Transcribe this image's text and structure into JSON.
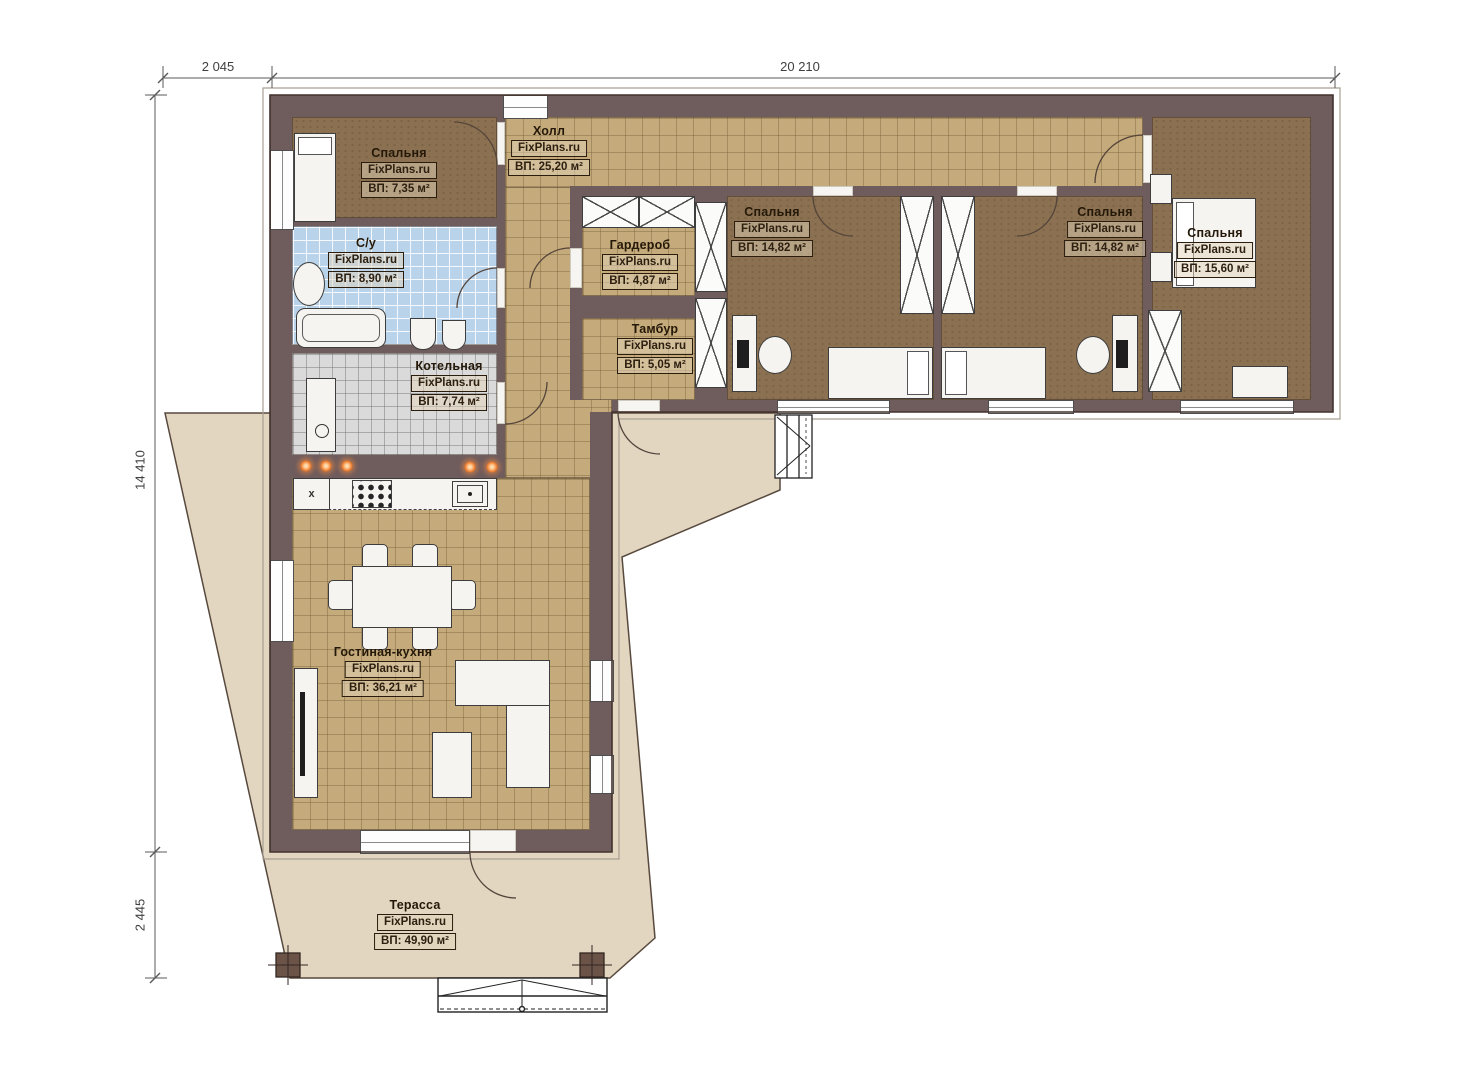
{
  "site": {
    "dimensions": {
      "top_left": "2 045",
      "top_right": "20 210",
      "left_upper": "14 410",
      "left_lower": "2 445"
    }
  },
  "rooms": [
    {
      "id": "bedroom-1",
      "title": "Спальня",
      "source": "FixPlans.ru",
      "area": "ВП: 7,35 м²"
    },
    {
      "id": "bathroom",
      "title": "С/у",
      "source": "FixPlans.ru",
      "area": "ВП: 8,90 м²"
    },
    {
      "id": "boiler-room",
      "title": "Котельная",
      "source": "FixPlans.ru",
      "area": "ВП: 7,74 м²"
    },
    {
      "id": "hall",
      "title": "Холл",
      "source": "FixPlans.ru",
      "area": "ВП: 25,20 м²"
    },
    {
      "id": "wardrobe",
      "title": "Гардероб",
      "source": "FixPlans.ru",
      "area": "ВП: 4,87 м²"
    },
    {
      "id": "vestibule",
      "title": "Тамбур",
      "source": "FixPlans.ru",
      "area": "ВП: 5,05 м²"
    },
    {
      "id": "bedroom-2",
      "title": "Спальня",
      "source": "FixPlans.ru",
      "area": "ВП: 14,82 м²"
    },
    {
      "id": "bedroom-3",
      "title": "Спальня",
      "source": "FixPlans.ru",
      "area": "ВП: 14,82 м²"
    },
    {
      "id": "bedroom-4",
      "title": "Спальня",
      "source": "FixPlans.ru",
      "area": "ВП: 15,60 м²"
    },
    {
      "id": "living-kitchen",
      "title": "Гостиная-кухня",
      "source": "FixPlans.ru",
      "area": "ВП: 36,21 м²"
    },
    {
      "id": "terrace",
      "title": "Терасса",
      "source": "FixPlans.ru",
      "area": "ВП: 49,90 м²"
    }
  ],
  "kitchen": {
    "sink_mark": "x"
  },
  "palette": {
    "wall": "#6f5c5d",
    "bedroom_floor": "#8b7151",
    "tile_floor": "#c5aa7b",
    "bathroom_floor": "#b9d3ea",
    "boiler_floor": "#dadada",
    "terrace": "#e2d6c1",
    "accent_orange": "#ef7f30"
  }
}
